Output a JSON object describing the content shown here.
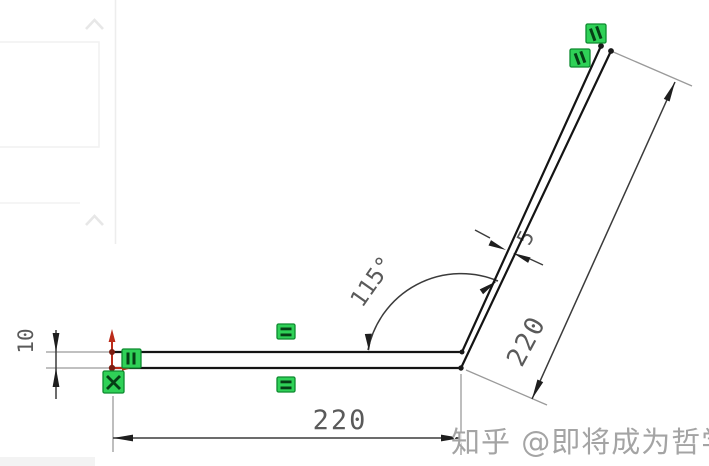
{
  "page": {
    "background": "#ffffff"
  },
  "watermark": {
    "text": "知乎 @即将成为哲学带师"
  },
  "sketch": {
    "dimensions": {
      "bottom_length": {
        "value": "220"
      },
      "slant_length": {
        "value": "220"
      },
      "bend_angle": {
        "value": "115°"
      },
      "thickness": {
        "value": "5"
      },
      "left_height": {
        "value": "10"
      }
    },
    "constraint_icons": {
      "equal_top": "equal-constraint",
      "equal_bottom": "equal-constraint",
      "slant_upper": "equal-constraint",
      "slant_lower": "equal-constraint",
      "origin_vertical": "vertical-constraint",
      "origin_fixed": "fixed-constraint"
    },
    "origin_icon": "origin-axes",
    "colors": {
      "sketch_line": "#141414",
      "dimension_line": "#3b3b3b",
      "extension_line": "#9a9a9a",
      "dimension_text": "#5a5a5a",
      "constraint_fill": "#2fd157",
      "constraint_border": "#0d8a2f",
      "constraint_glyph": "#063f16",
      "origin_red": "#bb2b1a",
      "watermark_text": "#a4a4a4"
    }
  },
  "side_panel": {
    "collapse_icon": "chevron-up"
  }
}
